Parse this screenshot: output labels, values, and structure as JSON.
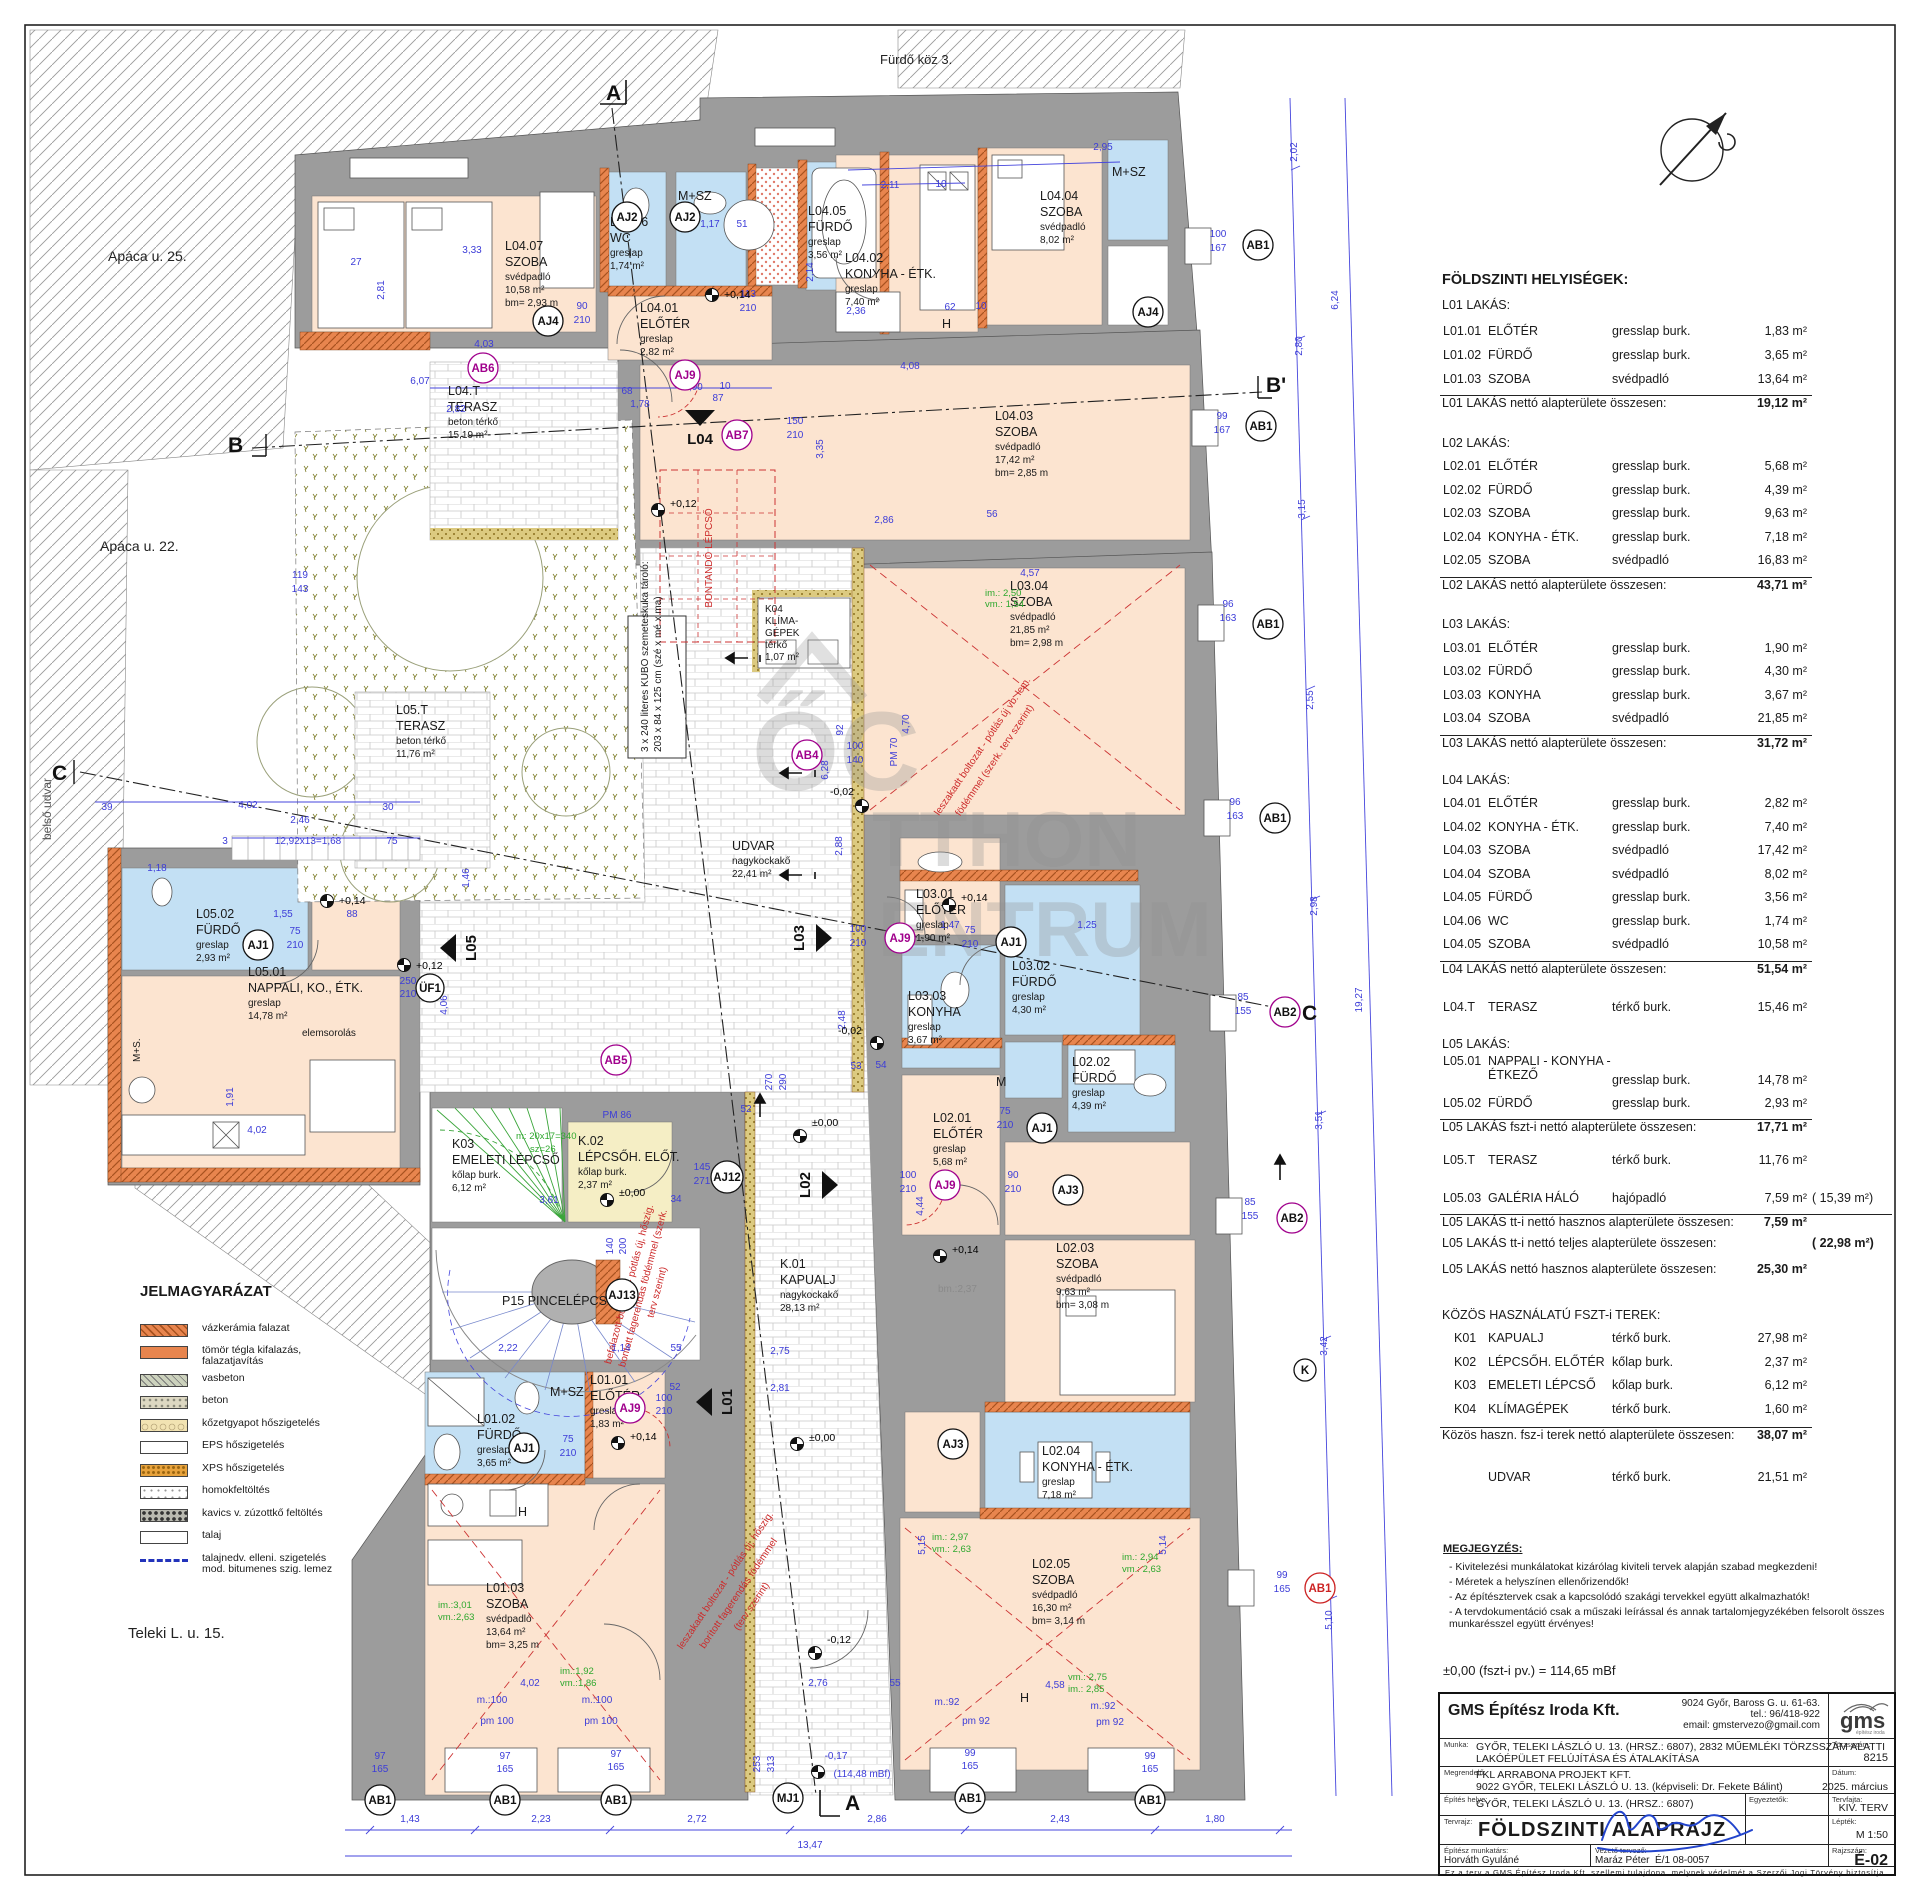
{
  "streets": {
    "apaca25": "Apáca u. 25.",
    "apaca22": "Apáca u. 22.",
    "belso": "belső udvar",
    "teleki": "Teleki L. u. 15.",
    "furdokoz": "Fürdő köz 3."
  },
  "watermark": {
    "monogram": "ŐC",
    "line1": "TTHON",
    "line2": "ENTRUM"
  },
  "plan": {
    "flags": {
      "L01": "L01",
      "L02": "L02",
      "L03": "L03",
      "L04": "L04",
      "L05": "L05",
      "A": "A",
      "B": "B",
      "Bp": "B'",
      "C": "C"
    },
    "markers": {
      "AB1": "AB1",
      "AB2": "AB2",
      "AB4": "AB4",
      "AB5": "AB5",
      "AB6": "AB6",
      "AB7": "AB7",
      "AJ1": "AJ1",
      "AJ2": "AJ2",
      "AJ3": "AJ3",
      "AJ4": "AJ4",
      "AJ9": "AJ9",
      "AJ12": "AJ12",
      "AJ13": "AJ13",
      "MJ1": "MJ1",
      "UF1": "ÜF1",
      "K": "K",
      "PM70": "PM 70",
      "PM86": "PM 86"
    },
    "rooms": [
      {
        "lines": [
          "L04.07",
          "SZOBA",
          "svédpadló",
          "10,58 m²",
          "bm= 2,93 m"
        ]
      },
      {
        "lines": [
          "L04.06",
          "WC",
          "greslap",
          "1,74 m²"
        ]
      },
      {
        "lines": [
          "M+SZ"
        ]
      },
      {
        "lines": [
          "L04.01",
          "ELŐTÉR",
          "greslap",
          "2,82 m²"
        ]
      },
      {
        "lines": [
          "L04.05",
          "FÜRDŐ",
          "greslap",
          "3,56 m²"
        ]
      },
      {
        "lines": [
          "L04.02",
          "KONYHA - ÉTK.",
          "greslap",
          "7,40 m²"
        ]
      },
      {
        "lines": [
          "L04.04",
          "SZOBA",
          "svédpadló",
          "8,02 m²"
        ]
      },
      {
        "lines": [
          "M+SZ"
        ]
      },
      {
        "lines": [
          "L04.03",
          "SZOBA",
          "svédpadló",
          "17,42 m²",
          "bm= 2,85 m"
        ]
      },
      {
        "lines": [
          "L04.T",
          "TERASZ",
          "beton térkő",
          "15,19 m²"
        ]
      },
      {
        "lines": [
          "L03.04",
          "SZOBA",
          "svédpadló",
          "21,85 m²",
          "bm= 2,98 m"
        ]
      },
      {
        "lines": [
          "K04",
          "KLÍMA-",
          "GÉPEK",
          "térkő",
          "1,07 m²"
        ]
      },
      {
        "lines": [
          "UDVAR",
          "nagykockakő",
          "22,41 m²"
        ]
      },
      {
        "lines": [
          "L05.T",
          "TERASZ",
          "beton térkő",
          "11,76 m²"
        ]
      },
      {
        "lines": [
          "L05.02",
          "FÜRDŐ",
          "greslap",
          "2,93 m²"
        ]
      },
      {
        "lines": [
          "L05.01",
          "NAPPALI, KO., ÉTK.",
          "greslap",
          "14,78 m²"
        ]
      },
      {
        "lines": [
          "elemsorolás"
        ]
      },
      {
        "lines": [
          "K03",
          "EMELETI LÉPCSŐ",
          "kőlap burk.",
          "6,12 m²"
        ]
      },
      {
        "lines": [
          "K.02",
          "LÉPCSŐH.  ELŐT.",
          "kőlap burk.",
          "2,37 m²"
        ]
      },
      {
        "lines": [
          "P15  PINCELÉPCSŐK"
        ]
      },
      {
        "lines": [
          "K.01",
          "KAPUALJ",
          "nagykockakő",
          "28,13 m²"
        ]
      },
      {
        "lines": [
          "L03.01",
          "ELŐTÉR",
          "greslap",
          "1,90 m²"
        ]
      },
      {
        "lines": [
          "L03.02",
          "FÜRDŐ",
          "greslap",
          "4,30 m²"
        ]
      },
      {
        "lines": [
          "L03.03",
          "KONYHA",
          "greslap",
          "3,67 m²"
        ]
      },
      {
        "lines": [
          "M"
        ]
      },
      {
        "lines": [
          "L02.02",
          "FÜRDŐ",
          "greslap",
          "4,39 m²"
        ]
      },
      {
        "lines": [
          "L02.01",
          "ELŐTÉR",
          "greslap",
          "5,68 m²"
        ]
      },
      {
        "lines": [
          "L02.03",
          "SZOBA",
          "svédpadló",
          "9,63 m²",
          "bm= 3,08 m"
        ]
      },
      {
        "lines": [
          "L02.04",
          "KONYHA - ÉTK.",
          "greslap",
          "7,18 m²"
        ]
      },
      {
        "lines": [
          "L02.05",
          "SZOBA",
          "svédpadló",
          "16,30 m²",
          "bm= 3,14 m"
        ]
      },
      {
        "lines": [
          "L01.02",
          "FÜRDŐ",
          "greslap",
          "3,65 m²"
        ]
      },
      {
        "lines": [
          "M+SZ"
        ]
      },
      {
        "lines": [
          "L01.01",
          "ELŐTÉR",
          "greslap",
          "1,83 m²"
        ]
      },
      {
        "lines": [
          "L01.03",
          "SZOBA",
          "svédpadló",
          "13,64 m²",
          "bm= 3,25 m"
        ]
      },
      {
        "lines": [
          "bm.:2,37"
        ]
      },
      {
        "lines": [
          "3 x 240 literes KUBO szemeteskuka tároló:",
          "203 x 84 x 125 cm (szé x mé x ma)"
        ]
      },
      {
        "lines": [
          "H"
        ]
      },
      {
        "lines": [
          "H"
        ]
      },
      {
        "lines": [
          "H"
        ]
      },
      {
        "lines": [
          "M+S."
        ]
      }
    ],
    "dims": [
      "2,11",
      "10",
      "2,95",
      "3,33",
      "27",
      "2,81",
      "4,03",
      "2,82",
      "1,78",
      "1,17",
      "51",
      "90",
      "210",
      "113",
      "210",
      "2,36",
      "62",
      "10",
      "4,08",
      "2,14",
      "150",
      "210",
      "3,35",
      "2,86",
      "56",
      "4,57",
      "100",
      "140",
      "6,28",
      "2,88",
      "92",
      "4,70",
      "2,48",
      "100",
      "210",
      "1,47",
      "75",
      "210",
      "1,25",
      "53",
      "54",
      "270",
      "290",
      "52",
      "75",
      "210",
      "100",
      "210",
      "90",
      "210",
      "145",
      "271",
      "3,61",
      "34",
      "2,22",
      "1,14",
      "55",
      "140",
      "200",
      "75",
      "210",
      "52",
      "100",
      "210",
      "4,44",
      "2,76",
      "55",
      "4,02",
      "m.:100",
      "m.:100",
      "pm 100",
      "pm 100",
      "m.:92",
      "m.:92",
      "pm 92",
      "pm 92",
      "97",
      "165",
      "97",
      "165",
      "97",
      "165",
      "99",
      "165",
      "99",
      "165",
      "253",
      "313",
      "-0,17",
      "(114,48 mBf)",
      "1,43",
      "2,23",
      "2,72",
      "2,86",
      "2,43",
      "1,80",
      "13,47",
      "2,02",
      "6,24",
      "2,80",
      "3,15",
      "2,55",
      "2,98",
      "3,51",
      "3,42",
      "5,10",
      "19,27",
      "100",
      "167",
      "99",
      "167",
      "96",
      "163",
      "96",
      "163",
      "85",
      "155",
      "85",
      "155",
      "99",
      "165",
      "39",
      "4,02",
      "2,46",
      "30",
      "3",
      "12,92x13=1,68",
      "75",
      "1,18",
      "1,55",
      "88",
      "75",
      "210",
      "1,91",
      "4,02",
      "119",
      "143",
      "250",
      "210",
      "4,06",
      "1,46",
      "5,15",
      "5,14",
      "4,58",
      "2,75",
      "2,81",
      "10",
      "1,00",
      "87",
      "68",
      "6,07"
    ],
    "greens": [
      "im.: 2,50",
      "vm.: 1,54",
      "im.:3,01",
      "vm.:2,63",
      "im.:1,92",
      "vm.:1,86",
      "im.: 2,97",
      "vm.: 2,63",
      "im.: 2,94",
      "vm.: 2,63",
      "vm.: 2,75",
      "im.: 2,85",
      "m: 20x17=340",
      "sz=26"
    ],
    "levels": [
      "+0,14",
      "+0,12",
      "+0,14",
      "-0,02",
      "-0,02",
      "±0,00",
      "±0,00",
      "+0,14",
      "+0,12",
      "+0,14",
      "+0,14",
      "±0,00",
      "-0,12"
    ],
    "reds": {
      "bontando": "BONTANDÓ LÉPCSŐ",
      "leszakadt1": "leszakadt boltozat - pótlás új vb. lem.",
      "leszakadt2": "födémmel (szerk. terv szerint)",
      "leszakadt3": "leszakadt boltozat - pótlás új, hőszig.",
      "leszakadt4": "borított fagerendás födémmel",
      "leszakadt5": "(terv szerint)",
      "befalazott1": "befalazott boltozat - pótlás új, hőszig.",
      "befalazott2": "bontott fagerendás födémmel (szerk.",
      "befalazott3": "terv szerint)"
    }
  },
  "schedule": {
    "title": "FÖLDSZINTI HELYISÉGEK:",
    "groups": [
      {
        "header": "L01 LAKÁS:",
        "rows": [
          [
            "L01.01",
            "ELŐTÉR",
            "gresslap burk.",
            "1,83 m²"
          ],
          [
            "L01.02",
            "FÜRDŐ",
            "gresslap burk.",
            "3,65 m²"
          ],
          [
            "L01.03",
            "SZOBA",
            "svédpadló",
            "13,64 m²"
          ]
        ],
        "total": [
          "L01 LAKÁS nettó alapterülete összesen:",
          "19,12 m²"
        ]
      },
      {
        "header": "L02 LAKÁS:",
        "rows": [
          [
            "L02.01",
            "ELŐTÉR",
            "gresslap burk.",
            "5,68 m²"
          ],
          [
            "L02.02",
            "FÜRDŐ",
            "gresslap burk.",
            "4,39 m²"
          ],
          [
            "L02.03",
            "SZOBA",
            "gresslap burk.",
            "9,63 m²"
          ],
          [
            "L02.04",
            "KONYHA - ÉTK.",
            "gresslap burk.",
            "7,18 m²"
          ],
          [
            "L02.05",
            "SZOBA",
            "svédpadló",
            "16,83 m²"
          ]
        ],
        "total": [
          "L02 LAKÁS nettó alapterülete összesen:",
          "43,71 m²"
        ]
      },
      {
        "header": "L03 LAKÁS:",
        "rows": [
          [
            "L03.01",
            "ELŐTÉR",
            "gresslap burk.",
            "1,90 m²"
          ],
          [
            "L03.02",
            "FÜRDŐ",
            "gresslap burk.",
            "4,30 m²"
          ],
          [
            "L03.03",
            "KONYHA",
            "gresslap burk.",
            "3,67 m²"
          ],
          [
            "L03.04",
            "SZOBA",
            "svédpadló",
            "21,85 m²"
          ]
        ],
        "total": [
          "L03 LAKÁS nettó alapterülete összesen:",
          "31,72 m²"
        ]
      },
      {
        "header": "L04 LAKÁS:",
        "rows": [
          [
            "L04.01",
            "ELŐTÉR",
            "gresslap burk.",
            "2,82 m²"
          ],
          [
            "L04.02",
            "KONYHA - ÉTK.",
            "gresslap burk.",
            "7,40 m²"
          ],
          [
            "L04.03",
            "SZOBA",
            "svédpadló",
            "17,42 m²"
          ],
          [
            "L04.04",
            "SZOBA",
            "svédpadló",
            "8,02 m²"
          ],
          [
            "L04.05",
            "FÜRDŐ",
            "gresslap burk.",
            "3,56 m²"
          ],
          [
            "L04.06",
            "WC",
            "gresslap burk.",
            "1,74 m²"
          ],
          [
            "L04.05",
            "SZOBA",
            "svédpadló",
            "10,58 m²"
          ]
        ],
        "total": [
          "L04 LAKÁS nettó alapterülete összesen:",
          "51,54 m²"
        ],
        "terasz": [
          "L04.T",
          "TERASZ",
          "térkő burk.",
          "15,46 m²"
        ]
      },
      {
        "header": "L05 LAKÁS:",
        "rows": [
          [
            "L05.01",
            "NAPPALI - KONYHA -\nÉTKEZŐ",
            "gresslap burk.",
            "14,78 m²"
          ],
          [
            "L05.02",
            "FÜRDŐ",
            "gresslap burk.",
            "2,93 m²"
          ]
        ],
        "total1": [
          "L05 LAKÁS fszt-i nettó alapterülete összesen:",
          "17,71 m²"
        ],
        "terasz": [
          "L05.T",
          "TERASZ",
          "térkő burk.",
          "11,76 m²"
        ],
        "galeria": [
          "L05.03",
          "GALÉRIA HÁLÓ",
          "hajópadló",
          "7,59 m²",
          "(  15,39 m²)"
        ],
        "total2": [
          "L05 LAKÁS tt-i nettó hasznos alapterülete összesen:",
          "7,59 m²",
          ""
        ],
        "total3": [
          "L05 LAKÁS tt-i nettó teljes alapterülete összesen:",
          "",
          "(  22,98 m²)"
        ],
        "total4": [
          "L05 LAKÁS nettó hasznos alapterülete összesen:",
          "25,30 m²",
          ""
        ]
      },
      {
        "header": "KÖZÖS HASZNÁLATÚ FSZT-i TEREK:",
        "rows": [
          [
            "K01",
            "KAPUALJ",
            "térkő burk.",
            "27,98 m²"
          ],
          [
            "K02",
            "LÉPCSŐH. ELŐTÉR",
            "kőlap burk.",
            "2,37 m²"
          ],
          [
            "K03",
            "EMELETI LÉPCSŐ",
            "kőlap burk.",
            "6,12 m²"
          ],
          [
            "K04",
            "KLÍMAGÉPEK",
            "térkő burk.",
            "1,60 m²"
          ]
        ],
        "total": [
          "Közös haszn. fsz-i terek nettó alapterülete összesen:",
          "38,07 m²"
        ],
        "udvar": [
          "",
          "UDVAR",
          "térkő burk.",
          "21,51 m²"
        ]
      }
    ]
  },
  "notes": {
    "title": "MEGJEGYZÉS:",
    "items": [
      "-  Kivitelezési munkálatokat kizárólag kiviteli tervek alapján szabad megkezdeni!",
      "-  Méretek a helyszínen ellenőrizendők!",
      "-  Az építésztervek csak a kapcsolódó szakági tervekkel együtt alkalmazhatók!",
      "-  A tervdokumentáció csak a műszaki leírással és annak tartalomjegyzékében felsorolt összes\n   munkarésszel együtt érvényes!"
    ]
  },
  "datum": "±0,00 (fszt-i pv.) = 114,65 mBf",
  "legend": {
    "title": "JELMAGYARÁZAT",
    "items": [
      {
        "label": "vázkerámia falazat"
      },
      {
        "label": "tömör tégla kifalazás,\nfalazatjavítás"
      },
      {
        "label": "vasbeton"
      },
      {
        "label": "beton"
      },
      {
        "label": "kőzetgyapot hőszigetelés"
      },
      {
        "label": "EPS hőszigetelés"
      },
      {
        "label": "XPS hőszigetelés"
      },
      {
        "label": "homokfeltöltés"
      },
      {
        "label": "kavics v. zúzottkő feltöltés"
      },
      {
        "label": "talaj"
      },
      {
        "label": "talajnedv. elleni. szigetelés\nmod. bitumenes szig. lemez"
      }
    ]
  },
  "titleblock": {
    "company": "GMS Építész Iroda Kft.",
    "address": "9024  Győr, Baross G. u. 61-63.\ntel.: 96/418-922\nemail: gmstervezo@gmail.com",
    "labels": {
      "munka": "Munka:",
      "megrendelo": "Megrendelő:",
      "epites": "Építés helye:",
      "tervrajz": "Tervrajz:",
      "munkatars": "Építész munkatárs:",
      "vezeto": "Vezető tervező:",
      "egyeztetok": "Egyeztetők:",
      "torzsszam": "Törzsszám:",
      "datum": "Dátum:",
      "tervfajta": "Tervfajta:",
      "leptek": "Lépték:",
      "rajzszam": "Rajzszám:"
    },
    "munka": "GYŐR, TELEKI LÁSZLÓ U. 13. (HRSZ.: 6807), 2832 MŰEMLÉKI TÖRZSSZÁM ALATTI\nLAKÓÉPÜLET FELÚJÍTÁSA ÉS ÁTALAKÍTÁSA",
    "megrendelo": "FKL ARRABONA PROJEKT KFT.\n9022  GYŐR, TELEKI LÁSZLÓ U. 13. (képviseli: Dr. Fekete Bálint)",
    "epites": "GYŐR, TELEKI LÁSZLÓ U. 13. (HRSZ.: 6807)",
    "tervrajz": "FÖLDSZINTI ALAPRAJZ",
    "munkatars": "Horváth Gyuláné",
    "vezeto": "Maráz Péter",
    "vezeto_no": "É/1 08-0057",
    "torzsszam": "8215",
    "datum": "2025. március",
    "tervfajta": "KIV. TERV",
    "leptek": "M 1:50",
    "rajzszam": "É-02",
    "logo": "gms",
    "logo_sub": "építész iroda",
    "copyright": "Ez a terv a GMS Építész Iroda  Kft. szellemi tulajdona, melynek védelmét a Szerzői Jogi Törvény biztosítja."
  }
}
